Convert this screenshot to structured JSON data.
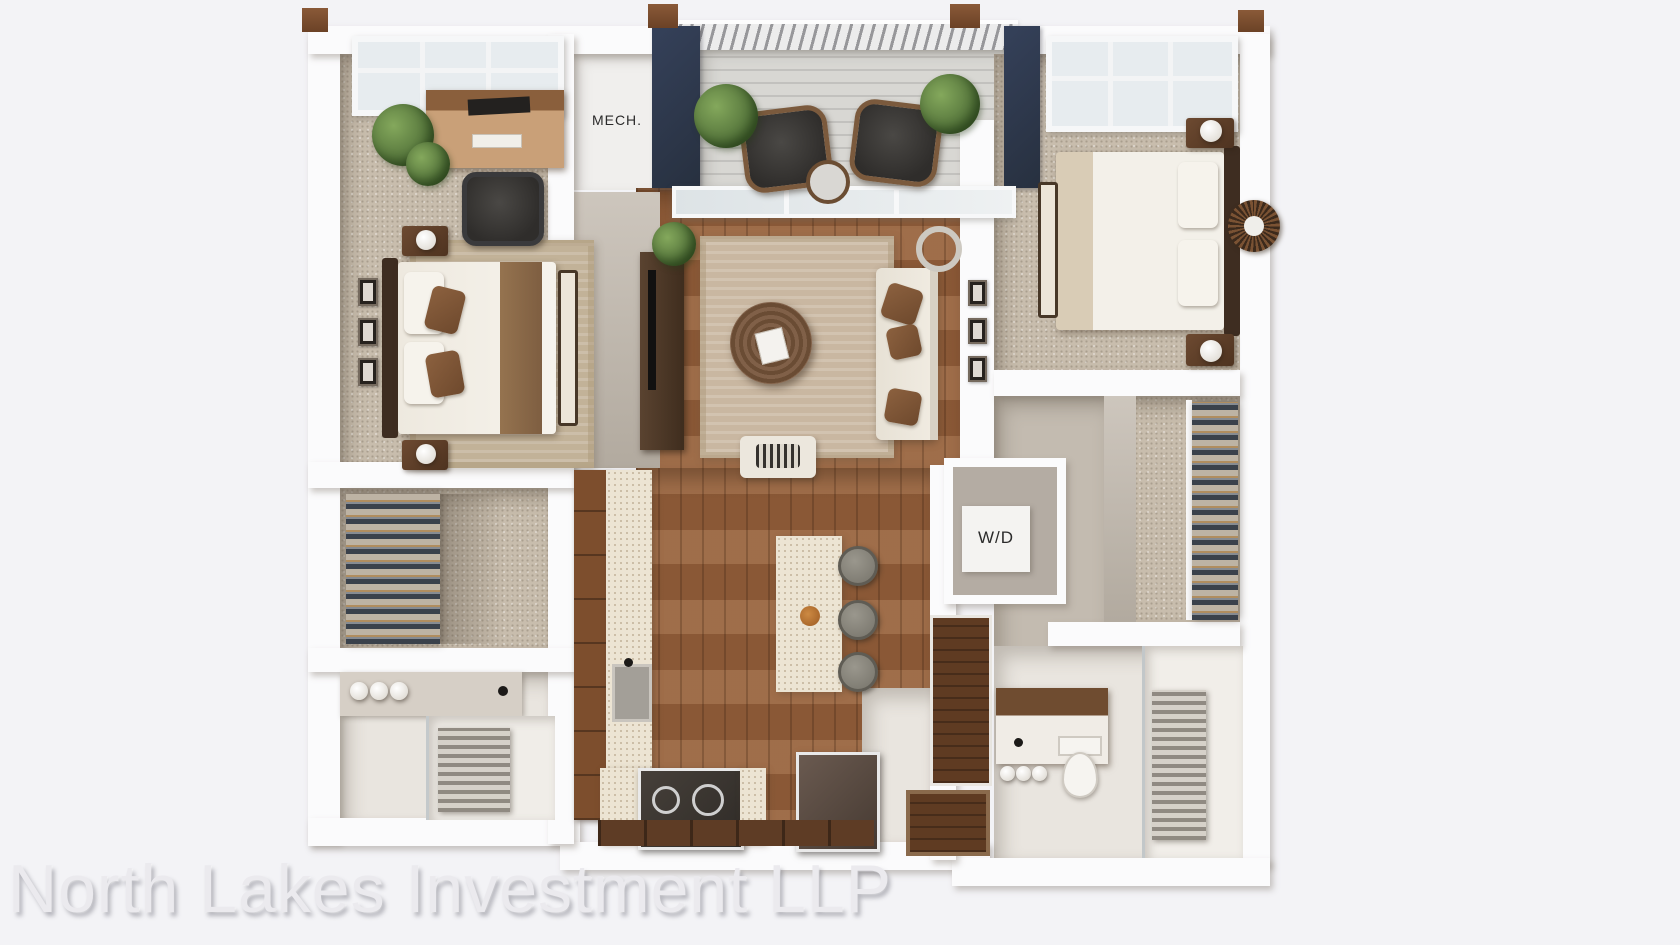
{
  "artwork": {
    "type": "3D apartment floor plan rendering, top-down view",
    "watermark": "North Lakes Investment LLP"
  },
  "labels": {
    "mech": "MECH.",
    "wd": "W/D"
  },
  "colors": {
    "background": "#f3f3f6",
    "wall": "#fbfbfc",
    "exterior_accent_navy": "#2d3747",
    "carpet": "#c8bdad",
    "hardwood": "#96613c",
    "balcony_deck": "#d8d7d3",
    "cabinet_brown": "#7d4e2d",
    "counter_cream": "#ece4d3",
    "plant_green": "#597c41",
    "watermark_text": "#ebeaee"
  }
}
